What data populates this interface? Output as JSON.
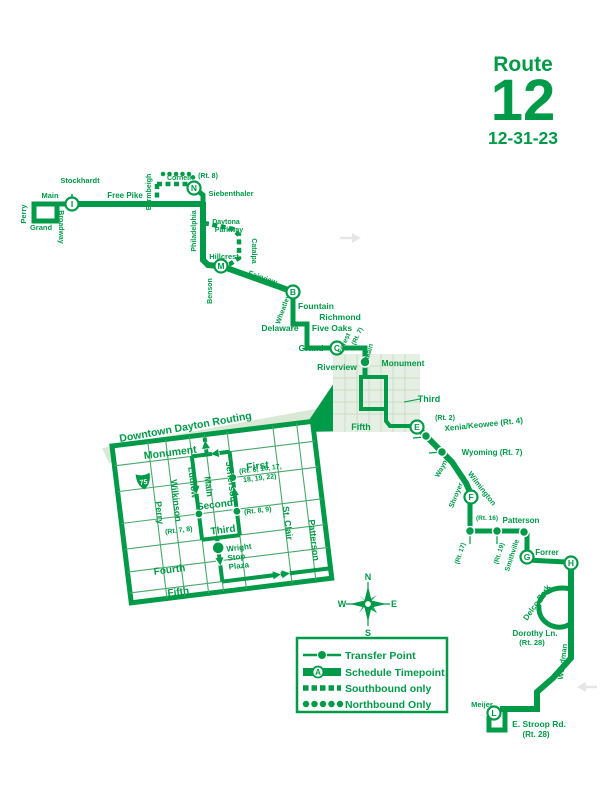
{
  "header": {
    "route_label": "Route",
    "route_number": "12",
    "date": "12-31-23"
  },
  "colors": {
    "route_green": "#009a48",
    "shade_fill": "#e6efe3",
    "grid_line": "#c9dcc6"
  },
  "compass": {
    "north": "N",
    "east": "E",
    "south": "S",
    "west": "W"
  },
  "legend": {
    "transfer_point": "Transfer Point",
    "schedule_timepoint": "Schedule Timepoint",
    "southbound_only": "Southbound only",
    "northbound_only": "Northbound Only",
    "sample_letter": "A"
  },
  "timepoints": {
    "i": "I",
    "n": "N",
    "m": "M",
    "b": "B",
    "c": "C",
    "e": "E",
    "f": "F",
    "g": "G",
    "h": "H",
    "l": "L"
  },
  "streets": {
    "stockhardt": "Stockhardt",
    "main_nw": "Main",
    "perry": "Perry",
    "grand_nw": "Grand",
    "broadway": "Broadway",
    "free_pike": "Free Pike",
    "bermbeigh": "Bermbeigh",
    "cornell": "Cornell",
    "cornell_route": "(Rt. 8)",
    "siebenthaler": "Siebenthaler",
    "philadelphia": "Philadelphia",
    "daytona": "Daytona",
    "parkway": "Parkway",
    "catalpa": "Catalpa",
    "hillcrest": "Hillcrest",
    "benson": "Benson",
    "fairview": "Fairview",
    "wheatley": "Wheatley",
    "fountain": "Fountain",
    "richmond": "Richmond",
    "five_oaks": "Five Oaks",
    "delaware": "Delaware",
    "grand": "Grand",
    "forest": "Forest",
    "forest_route": "(Rt. 7)",
    "main_mid": "Main",
    "riverview": "Riverview",
    "monument": "Monument",
    "third": "Third",
    "fifth": "Fifth",
    "third_route": "(Rt. 2)",
    "xenia": "Xenia/Keowee (Rt. 4)",
    "wyoming": "Wyoming (Rt. 7)",
    "wayne": "Wayne",
    "wilmington": "Wilmington",
    "shroyer": "Shroyer",
    "shroyer_route": "(Rt. 17)",
    "patterson_route": "(Rt. 16)",
    "patterson": "Patterson",
    "smithville_route": "(Rt. 19)",
    "smithville": "Smithville",
    "forrer": "Forrer",
    "delco_park": "Delco Park",
    "dorothy": "Dorothy Ln.",
    "dorothy_route": "(Rt. 28)",
    "woodman": "Woodman",
    "meijer": "Meijer",
    "stroop": "E. Stroop Rd.",
    "stroop_route": "(Rt. 28)"
  },
  "inset": {
    "title": "Downtown Dayton Routing",
    "interstate": "75",
    "streets_h": [
      "Monument",
      "First",
      "Second",
      "Third",
      "Fourth",
      "Fifth"
    ],
    "streets_v": [
      "Perry",
      "Wilkinson",
      "Ludlow",
      "Main",
      "Jefferson",
      "St. Clair",
      "Patterson"
    ],
    "first_routes_line1": "(Rt. 6, 16, 17,",
    "first_routes_line2": "18, 19, 22)",
    "jefferson_routes": "(Rt. 8, 9)",
    "ludlow_routes": "(Rt. 7, 8)",
    "plaza_line1": "Wright",
    "plaza_line2": "Stop",
    "plaza_line3": "Plaza"
  }
}
